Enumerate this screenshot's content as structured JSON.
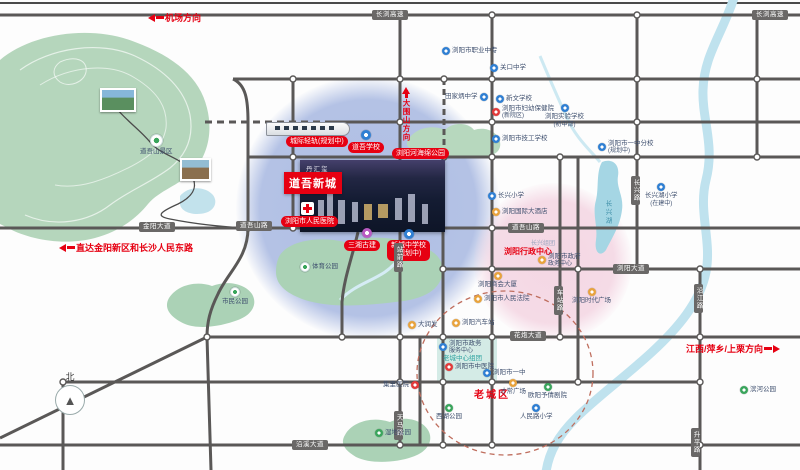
{
  "project": {
    "name": "道吾新城",
    "watermark": "丹汇玺"
  },
  "directions": {
    "airport": "机场方向",
    "jinyang": "直达金阳新区和长沙人民东路",
    "jiangxi": "江西/萍乡/上栗方向",
    "daweishan": "大围山方向"
  },
  "compass": "北",
  "colors": {
    "accent_red": "#e60012",
    "road_gray": "#5a5857",
    "zone_blue": "#aabae2",
    "zone_pink": "#f2cddd",
    "park_green": "#b5d6bc",
    "water_blue": "#bfe2ee"
  },
  "roads": {
    "pills": [
      "长浏高速",
      "长浏高速",
      "金阳大道",
      "道吾山路",
      "道吾山路",
      "浏阳大道",
      "花炮大道",
      "沿溪大道"
    ],
    "vpills": [
      "站前路",
      "长兴路",
      "沿江路",
      "升平路",
      "天马路",
      "车站路"
    ]
  },
  "landmarks": {
    "rail": "城际轻轨(规划中)",
    "daowu_school": "道吾学校",
    "sponge_park": "浏阳河海绵公园",
    "hospital": "浏阳市人民医院",
    "sanxiang": "三湘古建",
    "xincheng1": "新城中学校",
    "xincheng2": "(规划中)",
    "admin_center": "浏阳行政中心",
    "old_town": "老城区",
    "changxing_zu": "长兴组团",
    "changxing_lake": "长兴湖",
    "daowushan": "道吾山景区"
  },
  "pois": [
    {
      "label": "浏阳市职业中专"
    },
    {
      "label": "关口中学"
    },
    {
      "label": "田家炳中学"
    },
    {
      "label": "新文学校"
    },
    {
      "label": "浏阳市妇幼保健院",
      "label2": "(新院区)"
    },
    {
      "label": "浏阳实验学校",
      "label2": "(初中部)"
    },
    {
      "label": "浏阳市技工学校"
    },
    {
      "label": "浏阳市一中分校",
      "label2": "(规划中)"
    },
    {
      "label": "长兴湖小学",
      "label2": "(在建中)"
    },
    {
      "label": "长兴小学"
    },
    {
      "label": "浏阳国际大酒店"
    },
    {
      "label": "浏阳市政府",
      "label2": "政务中心"
    },
    {
      "label": "浏阳商会大厦"
    },
    {
      "label": "浏阳市人民法院"
    },
    {
      "label": "浏阳时代广场"
    },
    {
      "label": "大润发"
    },
    {
      "label": "浏阳汽车站"
    },
    {
      "label": "集里医院"
    },
    {
      "label": "浏阳市政务",
      "label2": "服务中心"
    },
    {
      "label": "老城中心组团"
    },
    {
      "label": "浏阳市中医院"
    },
    {
      "label": "浏阳市一中"
    },
    {
      "label": "欧阳予倩剧院"
    },
    {
      "label": "才常广场"
    },
    {
      "label": "西湖公园"
    },
    {
      "label": "人民路小学"
    },
    {
      "label": "滨河公园"
    },
    {
      "label": "市民公园"
    },
    {
      "label": "体育公园"
    },
    {
      "label": "湿地公园"
    }
  ]
}
